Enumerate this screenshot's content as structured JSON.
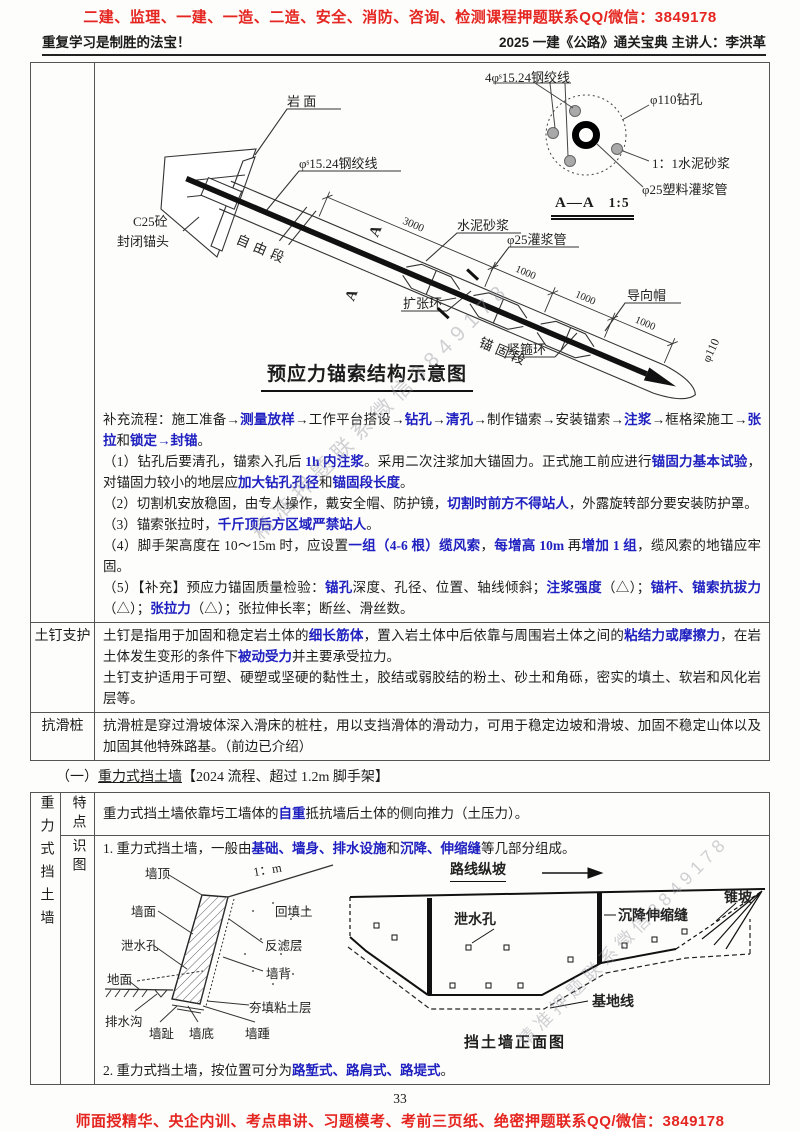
{
  "colors": {
    "accent_red": "#e52620",
    "accent_blue": "#1f20c0"
  },
  "banners": {
    "top": "二建、监理、一建、一造、二造、安全、消防、咨询、检测课程押题联系QQ/微信：3849178",
    "bottom": "师面授精华、央企内训、考点串讲、习题模考、考前三页纸、绝密押题联系QQ/微信：3849178"
  },
  "header": {
    "motto": "重复学习是制胜的法宝！",
    "edition": "2025 一建《公路》通关宝典 主讲人：李洪革"
  },
  "watermark": "精准押题联系微信3849178",
  "page_number": "33",
  "anchor_diagram": {
    "title": "预应力锚索结构示意图",
    "labels": {
      "rock_face": "岩  面",
      "strand": "φˢ15.24钢绞线",
      "strand4": "4φˢ15.24钢绞线",
      "drill_hole": "φ110钻孔",
      "mortar_ratio": "1：1水泥砂浆",
      "plastic_grout_pipe": "φ25塑料灌浆管",
      "section_mark": "A—A",
      "section_scale": "1:5",
      "anchor_head_1": "C25砼",
      "anchor_head_2": "封闭锚头",
      "free_segment": "自由段",
      "cement_mortar": "水泥砂浆",
      "grout_pipe": "φ25灌浆管",
      "expansion_ring": "扩张环",
      "guide_cap": "导向帽",
      "anchorage_segment": "锚固段",
      "hoop_ring": "紧箍环",
      "dia_110": "φ110",
      "dim_3000": "3000",
      "dim_1000": "1000",
      "cut_letter": "A"
    }
  },
  "anchor_row": {
    "label": "",
    "paragraphs": [
      [
        {
          "t": "补充流程：施工准备→"
        },
        {
          "t": "测量放样",
          "h": 1
        },
        {
          "t": "→工作平台搭设→"
        },
        {
          "t": "钻孔",
          "h": 1
        },
        {
          "t": "→"
        },
        {
          "t": "清孔",
          "h": 1
        },
        {
          "t": "→制作锚索→安装锚索→"
        },
        {
          "t": "注浆",
          "h": 1
        },
        {
          "t": "→框格梁施工→"
        },
        {
          "t": "张拉",
          "h": 1
        },
        {
          "t": "和"
        },
        {
          "t": "锁定→封锚",
          "h": 1
        },
        {
          "t": "。"
        }
      ],
      [
        {
          "t": "（1）钻孔后要清孔，锚索入孔后 "
        },
        {
          "t": "1h 内注浆",
          "h": 1
        },
        {
          "t": "。采用二次注浆加大锚固力。正式施工前应进行"
        },
        {
          "t": "锚固力基本试验",
          "h": 1
        },
        {
          "t": "，对锚固力较小的地层应"
        },
        {
          "t": "加大钻孔孔径",
          "h": 1
        },
        {
          "t": "和"
        },
        {
          "t": "锚固段长度",
          "h": 1
        },
        {
          "t": "。"
        }
      ],
      [
        {
          "t": "（2）切割机安放稳固，由专人操作，戴安全帽、防护镜，"
        },
        {
          "t": "切割时前方不得站人",
          "h": 1
        },
        {
          "t": "，外露旋转部分要安装防护罩。"
        }
      ],
      [
        {
          "t": "（3）锚索张拉时，"
        },
        {
          "t": "千斤顶后方区域严禁站人",
          "h": 1
        },
        {
          "t": "。"
        }
      ],
      [
        {
          "t": "（4）脚手架高度在 10～15m 时，应设置"
        },
        {
          "t": "一组（4-6 根）缆风索",
          "h": 1
        },
        {
          "t": "，"
        },
        {
          "t": "每增高 10m",
          "h": 1
        },
        {
          "t": " 再"
        },
        {
          "t": "增加 1 组",
          "h": 1
        },
        {
          "t": "，缆风索的地锚应牢固。"
        }
      ],
      [
        {
          "t": "（5）【补充】预应力锚固质量检验："
        },
        {
          "t": "锚孔",
          "h": 1
        },
        {
          "t": "深度、孔径、位置、轴线倾斜；"
        },
        {
          "t": "注浆强度",
          "h": 1
        },
        {
          "t": "（△）；"
        },
        {
          "t": "锚杆、锚索抗拔力",
          "h": 1
        },
        {
          "t": "（△）；"
        },
        {
          "t": "张拉力",
          "h": 1
        },
        {
          "t": "（△）；张拉伸长率；断丝、滑丝数。"
        }
      ]
    ]
  },
  "soil_nail_row": {
    "label": "土钉支护",
    "paragraphs": [
      [
        {
          "t": "土钉是指用于加固和稳定岩土体的"
        },
        {
          "t": "细长筋体",
          "h": 1
        },
        {
          "t": "，置入岩土体中后依靠与周围岩土体之间的"
        },
        {
          "t": "粘结力或摩擦力",
          "h": 1
        },
        {
          "t": "，在岩土体发生变形的条件下"
        },
        {
          "t": "被动受力",
          "h": 1
        },
        {
          "t": "并主要承受拉力。"
        }
      ],
      [
        {
          "t": "土钉支护适用于可塑、硬塑或坚硬的黏性土，胶结或弱胶结的粉土、砂土和角砾，密实的填土、软岩和风化岩层等。"
        }
      ]
    ]
  },
  "anti_slide_row": {
    "label": "抗滑桩",
    "paragraphs": [
      [
        {
          "t": "抗滑桩是穿过滑坡体深入滑床的桩柱，用以支挡滑体的滑动力，可用于稳定边坡和滑坡、加固不稳定山体以及加固其他特殊路基。（前边已介绍）"
        }
      ]
    ]
  },
  "gravity": {
    "heading": {
      "num": "（一）",
      "title": "重力式挡土墙",
      "note": "【2024 流程、超过 1.2m 脚手架】"
    },
    "side_label": "重力式挡土墙",
    "feature_label": "特点",
    "diagram_label": "识图",
    "feature_paragraph": [
      {
        "t": "重力式挡土墙依靠圬工墙体的"
      },
      {
        "t": "自重",
        "h": 1
      },
      {
        "t": "抵抗墙后土体的侧向推力（土压力）。"
      }
    ],
    "line1": [
      {
        "t": "1. 重力式挡土墙，一般由"
      },
      {
        "t": "基础、墙身、排水设施",
        "h": 1
      },
      {
        "t": "和"
      },
      {
        "t": "沉降、伸缩缝",
        "h": 1
      },
      {
        "t": "等几部分组成。"
      }
    ],
    "line2": [
      {
        "t": "2. 重力式挡土墙，按位置可分为"
      },
      {
        "t": "路堑式、路肩式、路堤式",
        "h": 1
      },
      {
        "t": "。"
      }
    ]
  },
  "wall_section": {
    "labels": {
      "wall_top": "墙顶",
      "wall_face": "墙面",
      "weep_hole": "泄水孔",
      "ground": "地面",
      "ditch": "排水沟",
      "toe": "墙趾",
      "bottom": "墙底",
      "heel": "墙踵",
      "backfill": "回填土",
      "filter_layer": "反滤层",
      "wall_back": "墙背",
      "clay_layer": "夯填粘土层",
      "slope": "1：m"
    }
  },
  "wall_front": {
    "title": "挡土墙正面图",
    "labels": {
      "route_slope": "路线纵坡",
      "weep_hole": "泄水孔",
      "joint": "沉降伸缩缝",
      "cone_slope": "锥坡",
      "base_line": "基地线"
    }
  }
}
